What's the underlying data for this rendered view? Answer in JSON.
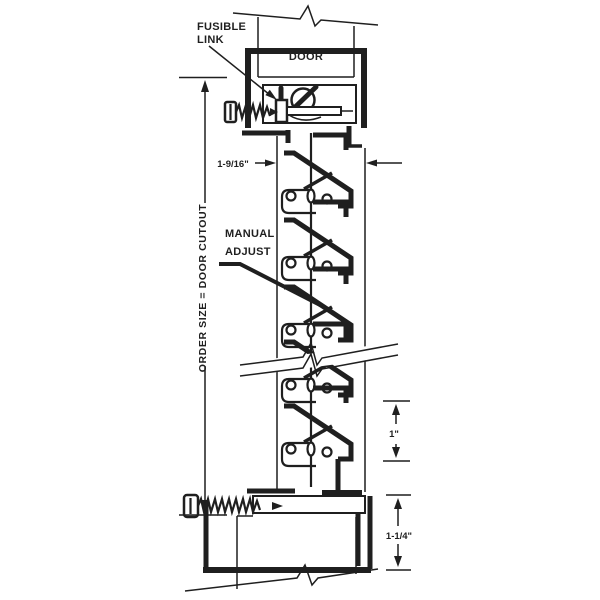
{
  "colors": {
    "ink": "#1f1f1f",
    "background": "#ffffff"
  },
  "labels": {
    "fusible_link_line1": "FUSIBLE",
    "fusible_link_line2": "LINK",
    "door_top": "DOOR",
    "manual_adjust_line1": "MANUAL",
    "manual_adjust_line2": "ADJUST",
    "order_size": "ORDER SIZE  =  DOOR CUTOUT"
  },
  "dimensions": {
    "louver_depth": "1-9/16\"",
    "blade_spacing": "1\"",
    "frame_height": "1-1/4\""
  }
}
